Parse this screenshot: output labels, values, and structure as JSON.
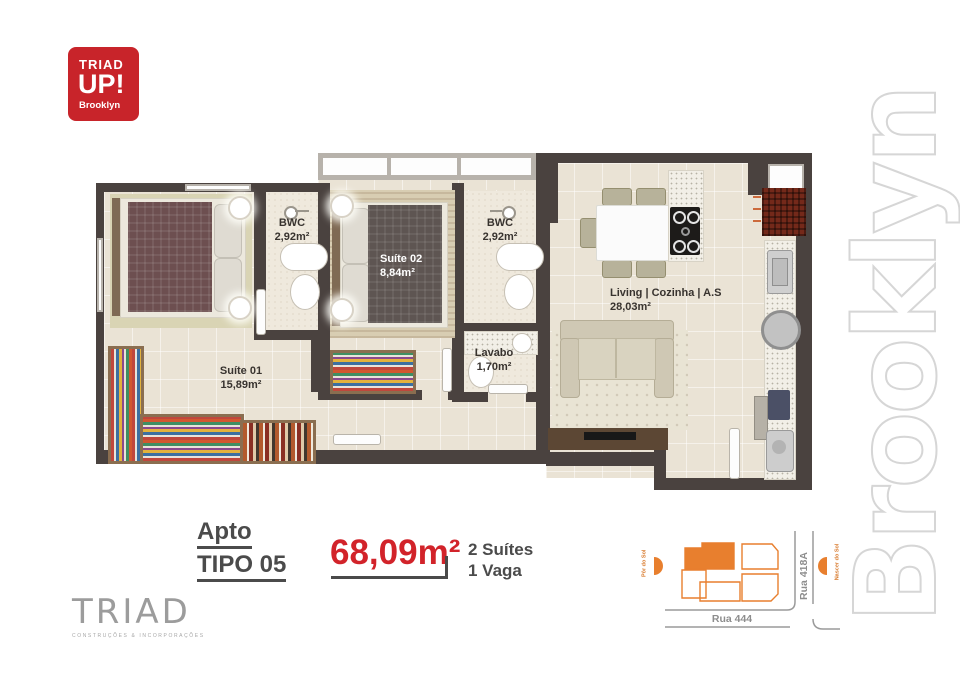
{
  "brand": {
    "logo_box": {
      "line1": "TRIAD",
      "line2": "UP!",
      "line3": "Brooklyn"
    },
    "watermark": "Brooklyn",
    "builder": {
      "name": "TRIAD",
      "subtitle": "CONSTRUÇÕES & INCORPORAÇÕES"
    }
  },
  "floorplan": {
    "rooms": {
      "suite01": {
        "name": "Suíte 01",
        "area": "15,89m²"
      },
      "bwc1": {
        "name": "BWC",
        "area": "2,92m²"
      },
      "suite02": {
        "name": "Suíte 02",
        "area": "8,84m²"
      },
      "bwc2": {
        "name": "BWC",
        "area": "2,92m²"
      },
      "lavabo": {
        "name": "Lavabo",
        "area": "1,70m²"
      },
      "living": {
        "name": "Living | Cozinha | A.S",
        "area": "28,03m²"
      }
    }
  },
  "unit_info": {
    "label_line1": "Apto",
    "label_line2": "TIPO 05",
    "total_area": "68,09m²",
    "feature_line1": "2 Suítes",
    "feature_line2": "1 Vaga"
  },
  "siteplan": {
    "street_bottom": "Rua 444",
    "street_right": "Rua 418A",
    "sun_west": "Pôr do Sol",
    "sun_east": "Nascer do Sol"
  },
  "colors": {
    "brand_red": "#c8242a",
    "area_red": "#d2232a",
    "site_orange": "#e87f2e",
    "wall": "#4a423f",
    "floor": "#eae3d5",
    "text_dark": "#4b4b4b",
    "watermark_outline": "#d6d6d6"
  }
}
